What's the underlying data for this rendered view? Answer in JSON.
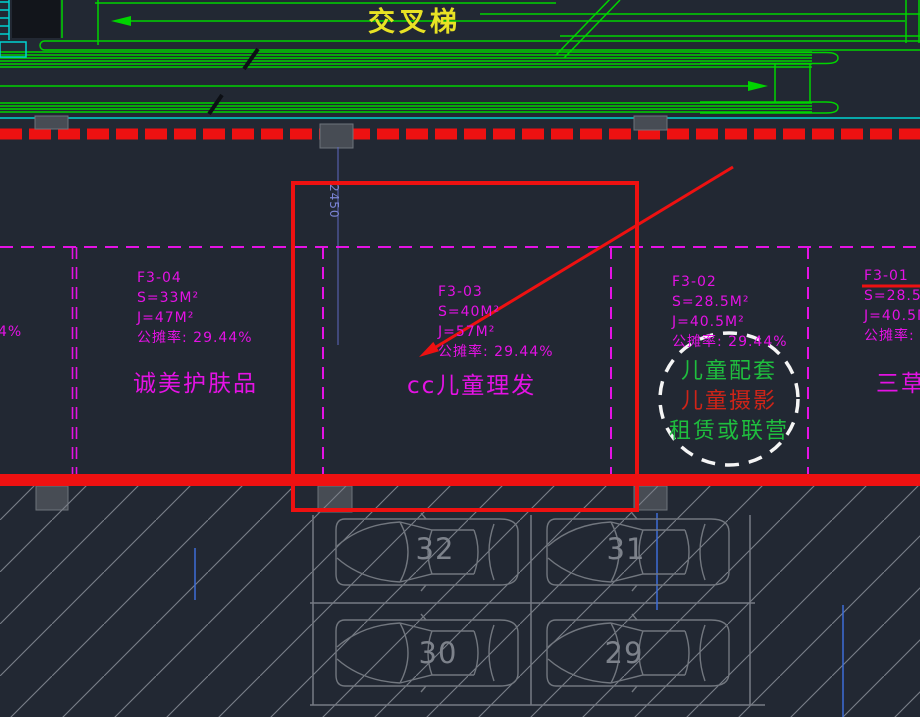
{
  "escalator": {
    "title": "交叉梯"
  },
  "dimension": {
    "value": "2450"
  },
  "units": [
    {
      "id": "F3-04",
      "s": "S=33M²",
      "j": "J=47M²",
      "share": "公摊率: 29.44%",
      "store": "诚美护肤品"
    },
    {
      "id": "F3-03",
      "s": "S=40M²",
      "j": "J=57M²",
      "share": "公摊率: 29.44%",
      "store": "cc儿童理发"
    },
    {
      "id": "F3-02",
      "s": "S=28.5M²",
      "j": "J=40.5M²",
      "share": "公摊率: 29.44%",
      "store": ""
    },
    {
      "id": "F3-01",
      "s": "S=28.5M²",
      "j": "J=40.5M²",
      "share": "公摊率:",
      "store": "三草"
    }
  ],
  "left_partial_text": "4%",
  "note_circle": {
    "lines": [
      {
        "text": "儿童配套",
        "color": "#1fbe3e"
      },
      {
        "text": "儿童摄影",
        "color": "#cf2418"
      },
      {
        "text": "租赁或联营",
        "color": "#1fbe3e"
      }
    ]
  },
  "parking_spaces": [
    "32",
    "31",
    "30",
    "29"
  ],
  "colors": {
    "background": "#222833",
    "line_green": "#00d400",
    "line_cyan": "#00d2d2",
    "annotation_red": "#ee1111",
    "label_magenta": "#e412e4",
    "dimension_blue": "#7b84d4",
    "car_gray": "#767b84",
    "title_yellow": "#e8e224"
  }
}
